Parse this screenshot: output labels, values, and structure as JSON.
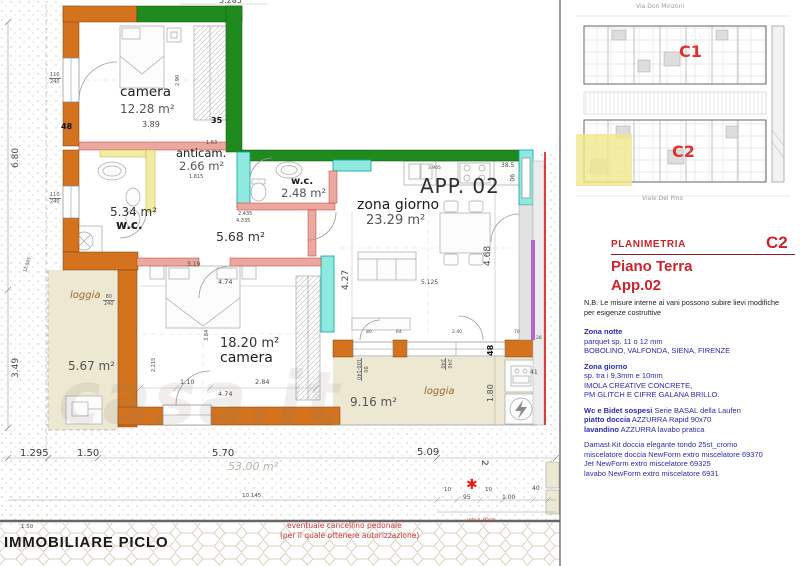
{
  "colors": {
    "wall_orange": "#D4731E",
    "wall_green": "#1F8B1F",
    "wall_cyan": "#8FE9DF",
    "wall_salmon": "#EBA89E",
    "wall_yellow": "#F0ECA4",
    "accent_purple": "#B266CC",
    "boundary_red": "#D01818",
    "loggia_beige": "#EDE8D2",
    "text_red": "#C9252B",
    "text_blue": "#2A2AB2"
  },
  "plan": {
    "app_label": "APP. 02",
    "rooms": [
      {
        "name": "camera",
        "area": "12.28 m²"
      },
      {
        "name": "anticam.",
        "area": "2.66 m²"
      },
      {
        "name": "w.c.",
        "area": "2.48 m²"
      },
      {
        "name": "w.c.",
        "area": "5.34 m²"
      },
      {
        "name": "",
        "area": "5.68 m²"
      },
      {
        "name": "zona giorno",
        "area": "23.29 m²"
      },
      {
        "name": "camera",
        "area": "18.20 m²"
      },
      {
        "name": "loggia",
        "area": "5.67 m²"
      },
      {
        "name": "loggia",
        "area": "9.16 m²"
      }
    ],
    "dims": [
      "6.80",
      "3.49",
      "12.845",
      "5.285",
      "3.89",
      "48",
      "35",
      "4.27",
      "4.68",
      "48",
      "1.80",
      "5.125",
      "4.74",
      "2.84",
      "1.10",
      "4.74",
      "3.19",
      "38.5",
      "90",
      "41",
      "2.435",
      "4.335",
      "1.295",
      "1.50",
      "5.70",
      "5.09",
      "10.145",
      "95",
      "1.00",
      "40",
      "10",
      "10",
      "2",
      "1.50",
      "3.965",
      "1.63",
      "1.815",
      "2.90",
      "3.84",
      "2.215",
      "80",
      "64",
      "2.40",
      "70",
      "28"
    ],
    "fractions": [
      {
        "t": "110",
        "b": "240"
      },
      {
        "t": "110",
        "b": "240"
      },
      {
        "t": "80",
        "b": "240"
      },
      {
        "t": "240",
        "b": "240"
      },
      {
        "t": "80",
        "b": "100-140"
      }
    ],
    "notes": {
      "star": "✱",
      "gate_line1": "eventuale cancellino pedonale",
      "gate_line2": "(per il quale ottenere autorizzazione)",
      "fence": "rete h. 95cm",
      "total_area": "53.00 m²"
    },
    "watermark": "casa.it",
    "footer": "IMMOBILIARE PICLO"
  },
  "siteplan": {
    "street_top": "Via Don Minzoni",
    "street_bottom": "Viale Del Pino",
    "building1": "C1",
    "building2": "C2"
  },
  "sidebar": {
    "section_label": "PLANIMETRIA",
    "code": "C2",
    "title_line1": "Piano Terra",
    "title_line2": "App.02",
    "nb_line1": "N.B. Le misure interne ai vani  possono subire lievi modifiche",
    "nb_line2": "per esigenze costruttive",
    "specs": [
      {
        "b": "Zona notte",
        "r": ""
      },
      {
        "b": "",
        "r": "parquet sp.  11 o 12 mm"
      },
      {
        "b": "",
        "r": "BOBOLINO, VALFONDA, SIENA, FIRENZE"
      },
      {
        "b": "Zona giorno",
        "r": ""
      },
      {
        "b": "",
        "r": "sp. tra i 9,3mm e 10mm"
      },
      {
        "b": "",
        "r": "IMOLA CREATIVE CONCRETE,"
      },
      {
        "b": "",
        "r": "PM GLITCH E CIFRE GALANA BRILLO."
      },
      {
        "b": "Wc e Bidet sospesi",
        "r": "  Serie BASAL della Laufen"
      },
      {
        "b": "piatto doccia",
        "r": " AZZURRA Rapid 90x70"
      },
      {
        "b": "lavandino",
        "r": "  AZZURRA lavabo pratica"
      },
      {
        "b": "",
        "r": "Damast  Kit doccia elegante tondo 25st_cromo"
      },
      {
        "b": "",
        "r": "miscelatore doccia NewForm extro miscelatore 69370"
      },
      {
        "b": "",
        "r": "Jet NewForm extro miscelatore 69325"
      },
      {
        "b": "",
        "r": "lavabo NewForm extro miscelatore 6931"
      }
    ]
  }
}
